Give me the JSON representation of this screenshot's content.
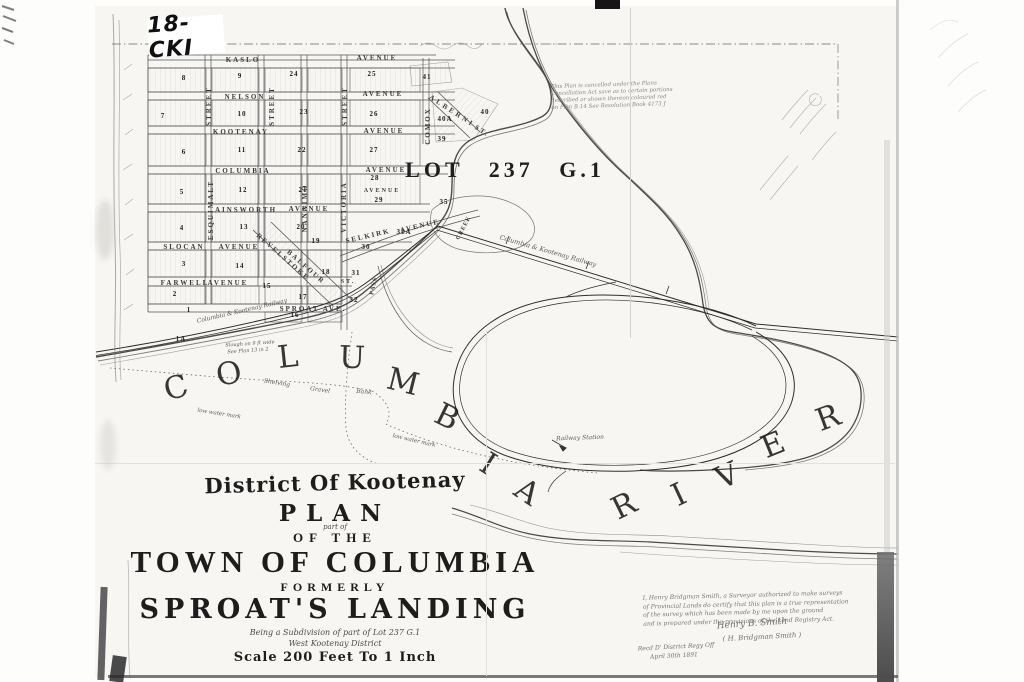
{
  "scan": {
    "archive_label": "18-CKI"
  },
  "map": {
    "lot_label": "LOT 237 G.1",
    "river_name": "COLUMBIA RIVER"
  },
  "title_block": {
    "district": "District Of Kootenay",
    "plan": "PLAN",
    "part_of": "part of",
    "of_the": "OF THE",
    "town": "TOWN OF COLUMBIA",
    "formerly": "FORMERLY",
    "sproats": "SPROAT'S LANDING",
    "being": "Being a Subdivision of part of Lot 237 G.1",
    "west": "West Kootenay District",
    "scale": "Scale 200 Feet To 1 Inch"
  },
  "notes": {
    "cancellation": [
      "This Plan is cancelled under the Plans",
      "Cancellation Act save as to certain portions",
      "described or shown thereon coloured red",
      "on Plan B.14  See Resolution Book 4173 J"
    ],
    "certificate": [
      "I, Henry Bridgman Smith, a Surveyor authorized to make surveys",
      "of Provincial Lands do certify that this plan is a true representation",
      "of the survey which has been made by me upon the ground",
      "and is prepared under the provisions of the Land Registry Act."
    ]
  },
  "labels": {
    "streets": [
      {
        "n": "street-kaslo",
        "t": "KASLO",
        "x": 243,
        "y": 60,
        "c": "mapcaps"
      },
      {
        "n": "street-kaslo-avenue",
        "t": "AVENUE",
        "x": 377,
        "y": 58,
        "c": "mapcaps"
      },
      {
        "n": "street-nelson",
        "t": "NELSON",
        "x": 245,
        "y": 97,
        "c": "mapcaps"
      },
      {
        "n": "street-nelson-avenue",
        "t": "AVENUE",
        "x": 383,
        "y": 94,
        "c": "mapcaps"
      },
      {
        "n": "street-kootenay",
        "t": "KOOTENAY",
        "x": 241,
        "y": 132,
        "c": "mapcaps"
      },
      {
        "n": "street-kootenay-avenue",
        "t": "AVENUE",
        "x": 384,
        "y": 131,
        "c": "mapcaps"
      },
      {
        "n": "street-columbia",
        "t": "COLUMBIA",
        "x": 243,
        "y": 171,
        "c": "mapcaps"
      },
      {
        "n": "street-columbia-avenue",
        "t": "AVENUE",
        "x": 386,
        "y": 170,
        "c": "mapcaps"
      },
      {
        "n": "street-east-avenue",
        "t": "AVENUE",
        "x": 382,
        "y": 191,
        "s": 6,
        "c": "mapcaps"
      },
      {
        "n": "street-ainsworth",
        "t": "AINSWORTH",
        "x": 246,
        "y": 210,
        "c": "mapcaps"
      },
      {
        "n": "street-ainsworth-avenue",
        "t": "AVENUE",
        "x": 309,
        "y": 209,
        "c": "mapcaps"
      },
      {
        "n": "street-slocan",
        "t": "SLOCAN",
        "x": 184,
        "y": 247,
        "c": "mapcaps"
      },
      {
        "n": "street-slocan-avenue",
        "t": "AVENUE",
        "x": 239,
        "y": 247,
        "c": "mapcaps"
      },
      {
        "n": "street-farwell",
        "t": "FARWELL",
        "x": 185,
        "y": 283,
        "c": "mapcaps"
      },
      {
        "n": "street-farwell-avenue",
        "t": "AVENUE",
        "x": 228,
        "y": 283,
        "c": "mapcaps"
      },
      {
        "n": "street-sproat",
        "t": "SPROAT AVE.",
        "x": 313,
        "y": 309,
        "c": "mapcaps"
      },
      {
        "n": "street-selkirk",
        "t": "SELKIRK",
        "x": 368,
        "y": 236,
        "r": -13,
        "c": "mapcaps"
      },
      {
        "n": "street-selkirk-avenue",
        "t": "AVENUE",
        "x": 420,
        "y": 226,
        "r": -13,
        "c": "mapcaps"
      },
      {
        "n": "street-st-short",
        "t": "ST.",
        "x": 348,
        "y": 282,
        "s": 6,
        "c": "mapcaps"
      },
      {
        "n": "street-alberni",
        "t": "ALBERNI",
        "x": 452,
        "y": 111,
        "r": 33,
        "ls": 3,
        "c": "mapcaps"
      },
      {
        "n": "street-alberni-st",
        "t": "ST.",
        "x": 482,
        "y": 131,
        "r": 33,
        "c": "mapcaps"
      },
      {
        "n": "street-vertical-1",
        "t": "STREET",
        "x": 209,
        "y": 106,
        "r": -90,
        "c": "mapcaps"
      },
      {
        "n": "street-vertical-2",
        "t": "STREET",
        "x": 272,
        "y": 106,
        "r": -90,
        "c": "mapcaps"
      },
      {
        "n": "street-vertical-3",
        "t": "STREET",
        "x": 345,
        "y": 106,
        "r": -90,
        "c": "mapcaps"
      },
      {
        "n": "street-esquimalt",
        "t": "ESQUIMALT",
        "x": 211,
        "y": 210,
        "r": -90,
        "c": "mapcaps"
      },
      {
        "n": "street-nanaimo",
        "t": "NANAIMO",
        "x": 305,
        "y": 208,
        "r": -90,
        "c": "mapcaps"
      },
      {
        "n": "street-victoria",
        "t": "VICTORIA",
        "x": 344,
        "y": 207,
        "r": -90,
        "c": "mapcaps"
      },
      {
        "n": "street-comox",
        "t": "COMOX",
        "x": 428,
        "y": 126,
        "r": -90,
        "c": "mapcaps"
      },
      {
        "n": "street-revelstoke",
        "t": "REVELSTOKE",
        "x": 283,
        "y": 257,
        "r": 41,
        "c": "mapcaps"
      },
      {
        "n": "street-balfour",
        "t": "BALFOUR",
        "x": 306,
        "y": 267,
        "r": 41,
        "c": "mapcaps"
      }
    ],
    "blocks": [
      {
        "n": "block-8",
        "t": "8",
        "x": 184,
        "y": 78,
        "c": "blocknum"
      },
      {
        "n": "block-9",
        "t": "9",
        "x": 240,
        "y": 76,
        "c": "blocknum"
      },
      {
        "n": "block-24",
        "t": "24",
        "x": 294,
        "y": 74,
        "c": "blocknum"
      },
      {
        "n": "block-25",
        "t": "25",
        "x": 372,
        "y": 74,
        "c": "blocknum"
      },
      {
        "n": "block-7",
        "t": "7",
        "x": 163,
        "y": 116,
        "c": "blocknum"
      },
      {
        "n": "block-10",
        "t": "10",
        "x": 242,
        "y": 114,
        "c": "blocknum"
      },
      {
        "n": "block-23",
        "t": "23",
        "x": 304,
        "y": 112,
        "c": "blocknum"
      },
      {
        "n": "block-26",
        "t": "26",
        "x": 374,
        "y": 114,
        "c": "blocknum"
      },
      {
        "n": "block-6",
        "t": "6",
        "x": 184,
        "y": 152,
        "c": "blocknum"
      },
      {
        "n": "block-11",
        "t": "11",
        "x": 242,
        "y": 150,
        "c": "blocknum"
      },
      {
        "n": "block-22",
        "t": "22",
        "x": 302,
        "y": 150,
        "c": "blocknum"
      },
      {
        "n": "block-27",
        "t": "27",
        "x": 374,
        "y": 150,
        "c": "blocknum"
      },
      {
        "n": "block-5",
        "t": "5",
        "x": 182,
        "y": 192,
        "c": "blocknum"
      },
      {
        "n": "block-12",
        "t": "12",
        "x": 243,
        "y": 190,
        "c": "blocknum"
      },
      {
        "n": "block-21",
        "t": "21",
        "x": 303,
        "y": 190,
        "c": "blocknum"
      },
      {
        "n": "block-28",
        "t": "28",
        "x": 375,
        "y": 178,
        "c": "blocknum"
      },
      {
        "n": "block-29",
        "t": "29",
        "x": 379,
        "y": 200,
        "c": "blocknum"
      },
      {
        "n": "block-4",
        "t": "4",
        "x": 182,
        "y": 228,
        "c": "blocknum"
      },
      {
        "n": "block-13",
        "t": "13",
        "x": 244,
        "y": 227,
        "c": "blocknum"
      },
      {
        "n": "block-20",
        "t": "20",
        "x": 301,
        "y": 227,
        "c": "blocknum"
      },
      {
        "n": "block-19",
        "t": "19",
        "x": 316,
        "y": 241,
        "c": "blocknum"
      },
      {
        "n": "block-31a",
        "t": "31A",
        "x": 404,
        "y": 232,
        "s": 7,
        "c": "blocknum"
      },
      {
        "n": "block-30",
        "t": "30",
        "x": 366,
        "y": 247,
        "c": "blocknum"
      },
      {
        "n": "block-3",
        "t": "3",
        "x": 184,
        "y": 264,
        "c": "blocknum"
      },
      {
        "n": "block-14",
        "t": "14",
        "x": 240,
        "y": 266,
        "c": "blocknum"
      },
      {
        "n": "block-18",
        "t": "18",
        "x": 326,
        "y": 272,
        "c": "blocknum"
      },
      {
        "n": "block-31",
        "t": "31",
        "x": 356,
        "y": 273,
        "c": "blocknum"
      },
      {
        "n": "block-2",
        "t": "2",
        "x": 175,
        "y": 294,
        "c": "blocknum"
      },
      {
        "n": "block-1",
        "t": "1",
        "x": 189,
        "y": 310,
        "c": "blocknum"
      },
      {
        "n": "block-15",
        "t": "15",
        "x": 267,
        "y": 286,
        "c": "blocknum"
      },
      {
        "n": "block-17",
        "t": "17",
        "x": 303,
        "y": 297,
        "c": "blocknum"
      },
      {
        "n": "block-32",
        "t": "32",
        "x": 354,
        "y": 300,
        "c": "blocknum"
      },
      {
        "n": "block-16",
        "t": "16",
        "x": 295,
        "y": 315,
        "c": "blocknum"
      },
      {
        "n": "block-1a",
        "t": "1A",
        "x": 181,
        "y": 339,
        "s": 7,
        "c": "blocknum"
      },
      {
        "n": "block-35",
        "t": "35",
        "x": 444,
        "y": 202,
        "s": 7,
        "c": "blocknum"
      },
      {
        "n": "block-41",
        "t": "41",
        "x": 427,
        "y": 77,
        "c": "blocknum"
      },
      {
        "n": "block-40",
        "t": "40",
        "x": 485,
        "y": 112,
        "c": "blocknum"
      },
      {
        "n": "block-40a",
        "t": "40A",
        "x": 445,
        "y": 119,
        "s": 7,
        "c": "blocknum"
      },
      {
        "n": "block-39",
        "t": "39",
        "x": 442,
        "y": 139,
        "c": "blocknum"
      }
    ],
    "water": [
      {
        "n": "lot-label",
        "t": "LOT 237 G.1",
        "x": 505,
        "y": 170,
        "s": 22,
        "ls": 4,
        "c": "lot"
      },
      {
        "n": "creek-label-pass",
        "t": "PASS",
        "x": 374,
        "y": 286,
        "r": -78,
        "s": 6,
        "ls": 1,
        "c": "mapcaps"
      },
      {
        "n": "creek-label-creek",
        "t": "CREEK",
        "x": 464,
        "y": 228,
        "r": -62,
        "s": 6,
        "ls": 1,
        "c": "mapcaps"
      },
      {
        "n": "railway-label-shore",
        "t": "Columbia & Kootenay Railway",
        "x": 242,
        "y": 311,
        "r": -13,
        "s": 6,
        "c": "script"
      },
      {
        "n": "railway-label-line",
        "t": "Columbia & Kootenay Railway",
        "x": 548,
        "y": 251,
        "r": 16,
        "s": 6.5,
        "c": "script"
      },
      {
        "n": "railway-station-label",
        "t": "Railway Station",
        "x": 580,
        "y": 438,
        "r": -2,
        "s": 6,
        "c": "script"
      },
      {
        "n": "shore-note-shelving",
        "t": "Shelving",
        "x": 277,
        "y": 383,
        "r": 9,
        "s": 6,
        "c": "script"
      },
      {
        "n": "shore-note-gravel",
        "t": "Gravel",
        "x": 320,
        "y": 390,
        "r": 8,
        "s": 6,
        "c": "script"
      },
      {
        "n": "shore-note-bank",
        "t": "Bank",
        "x": 364,
        "y": 392,
        "r": 6,
        "s": 6,
        "c": "script"
      },
      {
        "n": "low-water-mark-1",
        "t": "low water mark",
        "x": 219,
        "y": 414,
        "r": 9,
        "s": 5.5,
        "c": "script"
      },
      {
        "n": "low-water-mark-2",
        "t": "low water mark",
        "x": 414,
        "y": 441,
        "r": 13,
        "s": 5.5,
        "c": "script"
      },
      {
        "n": "shore-note-slough-1",
        "t": "Slough on 9 ft wide",
        "x": 250,
        "y": 344,
        "r": -4,
        "s": 5,
        "c": "script"
      },
      {
        "n": "shore-note-slough-2",
        "t": "See Plan 13 in 2",
        "x": 248,
        "y": 351,
        "r": -4,
        "s": 5,
        "c": "script"
      }
    ],
    "annotations": [
      {
        "n": "signature-name",
        "t": "Henry B. Smith",
        "x": 752,
        "y": 624,
        "r": -4,
        "s": 9,
        "c": "hand"
      },
      {
        "n": "signature-paren",
        "t": "( H. Bridgman Smith )",
        "x": 762,
        "y": 637,
        "r": -3,
        "s": 7,
        "c": "hand"
      },
      {
        "n": "received-note",
        "t": "Recd D' District Regy Off",
        "x": 676,
        "y": 647,
        "r": -3,
        "s": 6,
        "c": "hand"
      },
      {
        "n": "received-date",
        "t": "April 30th 1891",
        "x": 674,
        "y": 656,
        "r": -3,
        "s": 6,
        "c": "hand"
      }
    ]
  }
}
